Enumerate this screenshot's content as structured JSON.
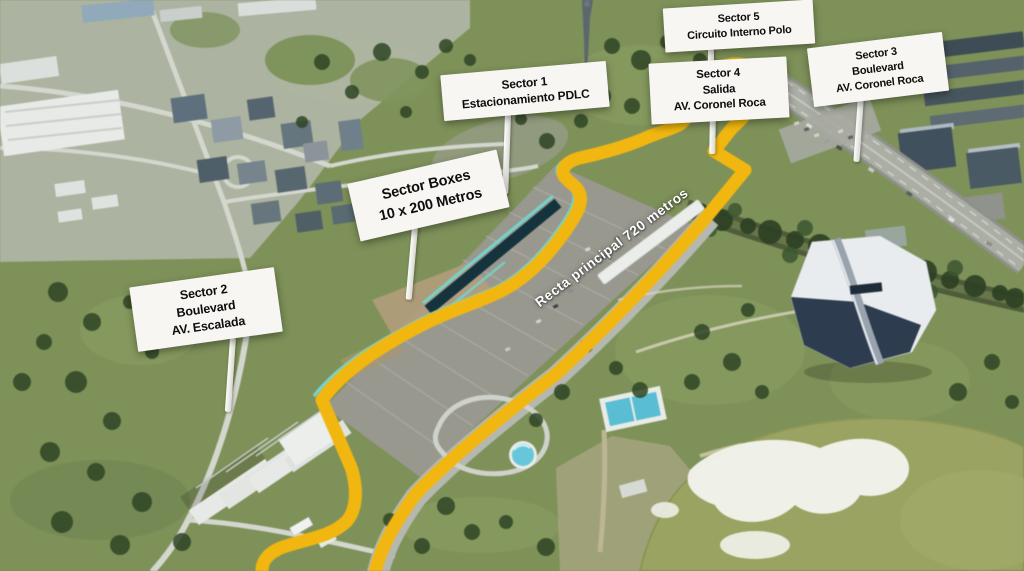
{
  "signs": {
    "sector1": {
      "line1": "Sector 1",
      "line2": "Estacionamiento PDLC"
    },
    "sector2": {
      "line1": "Sector 2",
      "line2": "Boulevard",
      "line3": "AV. Escalada"
    },
    "sector3": {
      "line1": "Sector 3",
      "line2": "Boulevard",
      "line3": "AV. Coronel Roca"
    },
    "sector4": {
      "line1": "Sector 4",
      "line2": "Salida",
      "line3": "AV. Coronel Roca"
    },
    "sector5": {
      "line1": "Sector 5",
      "line2": "Circuito Interno Polo"
    },
    "boxes": {
      "line1": "Sector Boxes",
      "line2": "10 x 200 Metros"
    }
  },
  "track": {
    "main_straight_label": "Recta principal 720 metros",
    "track_color": "#F3B70B",
    "pit_lane_color": "#74D4CC",
    "pit_boxes_color": "#14333E",
    "sign_background": "#F7F6F2",
    "straight_label_color": "#FFFFFF"
  }
}
